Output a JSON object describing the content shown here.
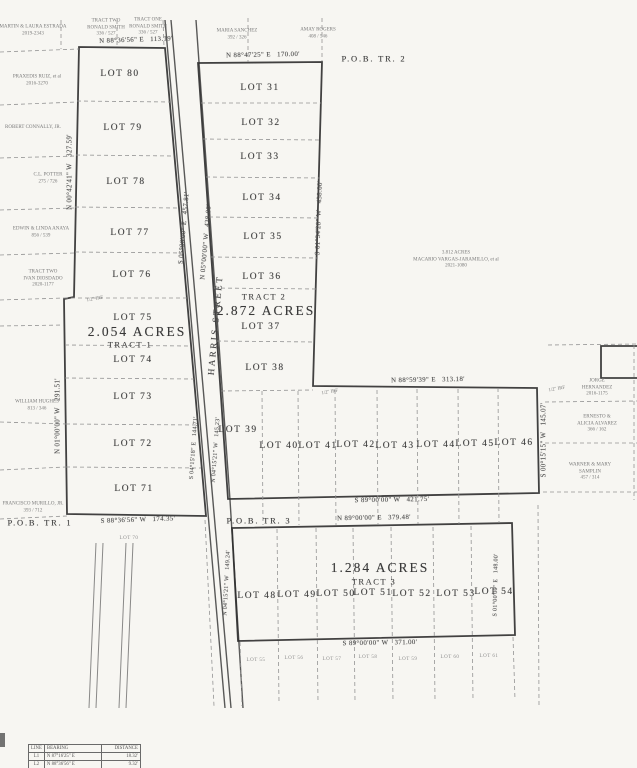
{
  "tract1": {
    "pob": "P.O.B. TR. 1",
    "name": "TRACT 1",
    "area": "2.054 ACRES",
    "lots": [
      "LOT 80",
      "LOT 79",
      "LOT 78",
      "LOT 77",
      "LOT 76",
      "LOT 75",
      "LOT 74",
      "LOT 73",
      "LOT 72",
      "LOT 71"
    ],
    "south_lot": "LOT 70",
    "bearing_top": "N 88°36'56\" E   113.19'",
    "bearing_left_upper": "N 00°42'41\" W   327.59'",
    "bearing_left_lower": "N 01°00'00\" W   291.51'",
    "bearing_bottom": "S 88°36'56\" W   174.35'"
  },
  "tract2": {
    "pob": "P.O.B. TR. 2",
    "name": "TRACT 2",
    "area": "2.872 ACRES",
    "lots_column": [
      "LOT 31",
      "LOT 32",
      "LOT 33",
      "LOT 34",
      "LOT 35",
      "LOT 36",
      "LOT 37",
      "LOT 38"
    ],
    "lot_west": "LOT 39",
    "lots_row": [
      "LOT 40",
      "LOT 41",
      "LOT 42",
      "LOT 43",
      "LOT 44",
      "LOT 45",
      "LOT 46"
    ],
    "bearing_top": "N 88°47'25\" E   170.00'",
    "bearing_east_upper": "S 01°34'28\" W   438.00'",
    "bearing_step": "N 88°59'39\" E   313.18'",
    "bearing_east_lower": "S 00°15'15\" W   145.07'",
    "bearing_bottom": "S 89°00'00\" W   421.75'"
  },
  "tract3": {
    "pob": "P.O.B. TR. 3",
    "name": "TRACT 3",
    "area": "1.284 ACRES",
    "lots": [
      "LOT 48",
      "LOT 49",
      "LOT 50",
      "LOT 51",
      "LOT 52",
      "LOT 53",
      "LOT 54"
    ],
    "south_lots": [
      "LOT 55",
      "LOT 56",
      "LOT 57",
      "LOT 58",
      "LOT 59",
      "LOT 60",
      "LOT 61"
    ],
    "bearing_top": "N 89°00'00\" E   379.48'",
    "bearing_west": "N 04°15'21\" W   149.24'",
    "bearing_east": "S 01°00'00\" E   148.00'",
    "bearing_bottom": "S 89°00'00\" W   371.00'"
  },
  "street": {
    "name": "HARRIS STREET",
    "bearing_west": "S 05°00'00\" E   457.81'",
    "bearing_east": "N 05°00'00\" W   438.00'",
    "bearing_west_lower": "S 04°15'18\" E   144.71'",
    "bearing_east_lower": "N 04°15'21\" W   145.23'"
  },
  "adjoiners": {
    "north_t1_a": "TRACT TWO\nRONALD SMITH\n336 / 527",
    "north_t1_b": "TRACT ONE\nRONALD SMITH\n336 / 527",
    "north_t2_a": "MARIA SANCHEZ\n392 / 326",
    "north_t2_b": "AMAY ROGERS\n408 / 546",
    "west_1": "MARTIN & LAURA ESTRADA\n2019-2343",
    "west_2": "PRAXEDIS RUIZ, et al\n2016-3270",
    "west_3": "ROBERT CONNALLY, JR.",
    "west_4": "C.L. POTTER\n275 / 726",
    "west_5": "EDWIN & LINDA ANAYA\n856 / 539",
    "west_6": "TRACT TWO\nIVAN DIOSDADO\n2020-1177",
    "west_7": "WILLIAM HUGHES\n813 / 346",
    "west_8": "FRANCISCO MURILLO, JR.\n393 / 712",
    "east_1": "3.812 ACRES\nMACARIO VARGAS-JARAMILLO, et al\n2021-1080",
    "east_2": "JORGE HERNANDEZ\n2016-1175",
    "east_3": "ERNESTO & ALICIA ALVAREZ\n366 / 162",
    "east_4": "WARNER & MARY SAMPLIN\n457 / 314"
  },
  "markers": {
    "irf": "1/2\" IRF"
  },
  "line_table": {
    "headers": [
      "LINE",
      "BEARING",
      "DISTANCE"
    ],
    "rows": [
      {
        "line": "L1",
        "bearing": "N 87°16'25\" E",
        "distance": "18.32'"
      },
      {
        "line": "L2",
        "bearing": "N 88°36'56\" E",
        "distance": "9.32'"
      }
    ]
  }
}
